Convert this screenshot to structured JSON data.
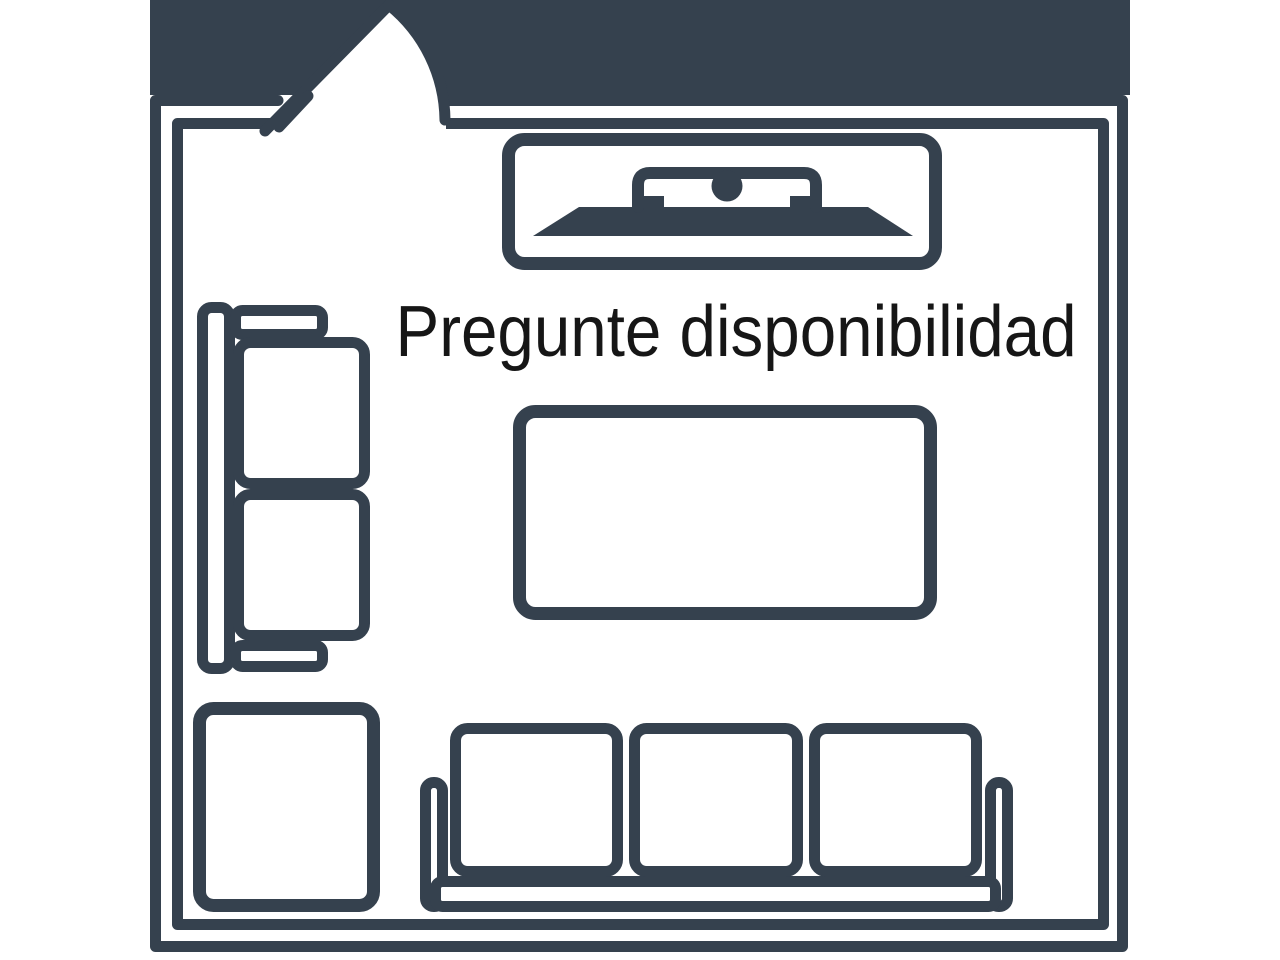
{
  "image": {
    "kind": "floor-plan-placeholder",
    "caption": "Pregunte disponibilidad",
    "colors": {
      "wall": "#35414E",
      "banner": "#000000",
      "background": "#FFFFFF",
      "caption": "#161616"
    },
    "room": {
      "walls": "double-outline rectangle",
      "door": {
        "name": "door-swing",
        "location": "top-left"
      }
    },
    "furniture": [
      {
        "name": "tv-console",
        "location": "top-center"
      },
      {
        "name": "loveseat",
        "location": "left-wall",
        "seats": 2
      },
      {
        "name": "coffee-table",
        "location": "center"
      },
      {
        "name": "side-table",
        "location": "bottom-left"
      },
      {
        "name": "sofa",
        "location": "bottom-center",
        "seats": 3
      }
    ]
  }
}
